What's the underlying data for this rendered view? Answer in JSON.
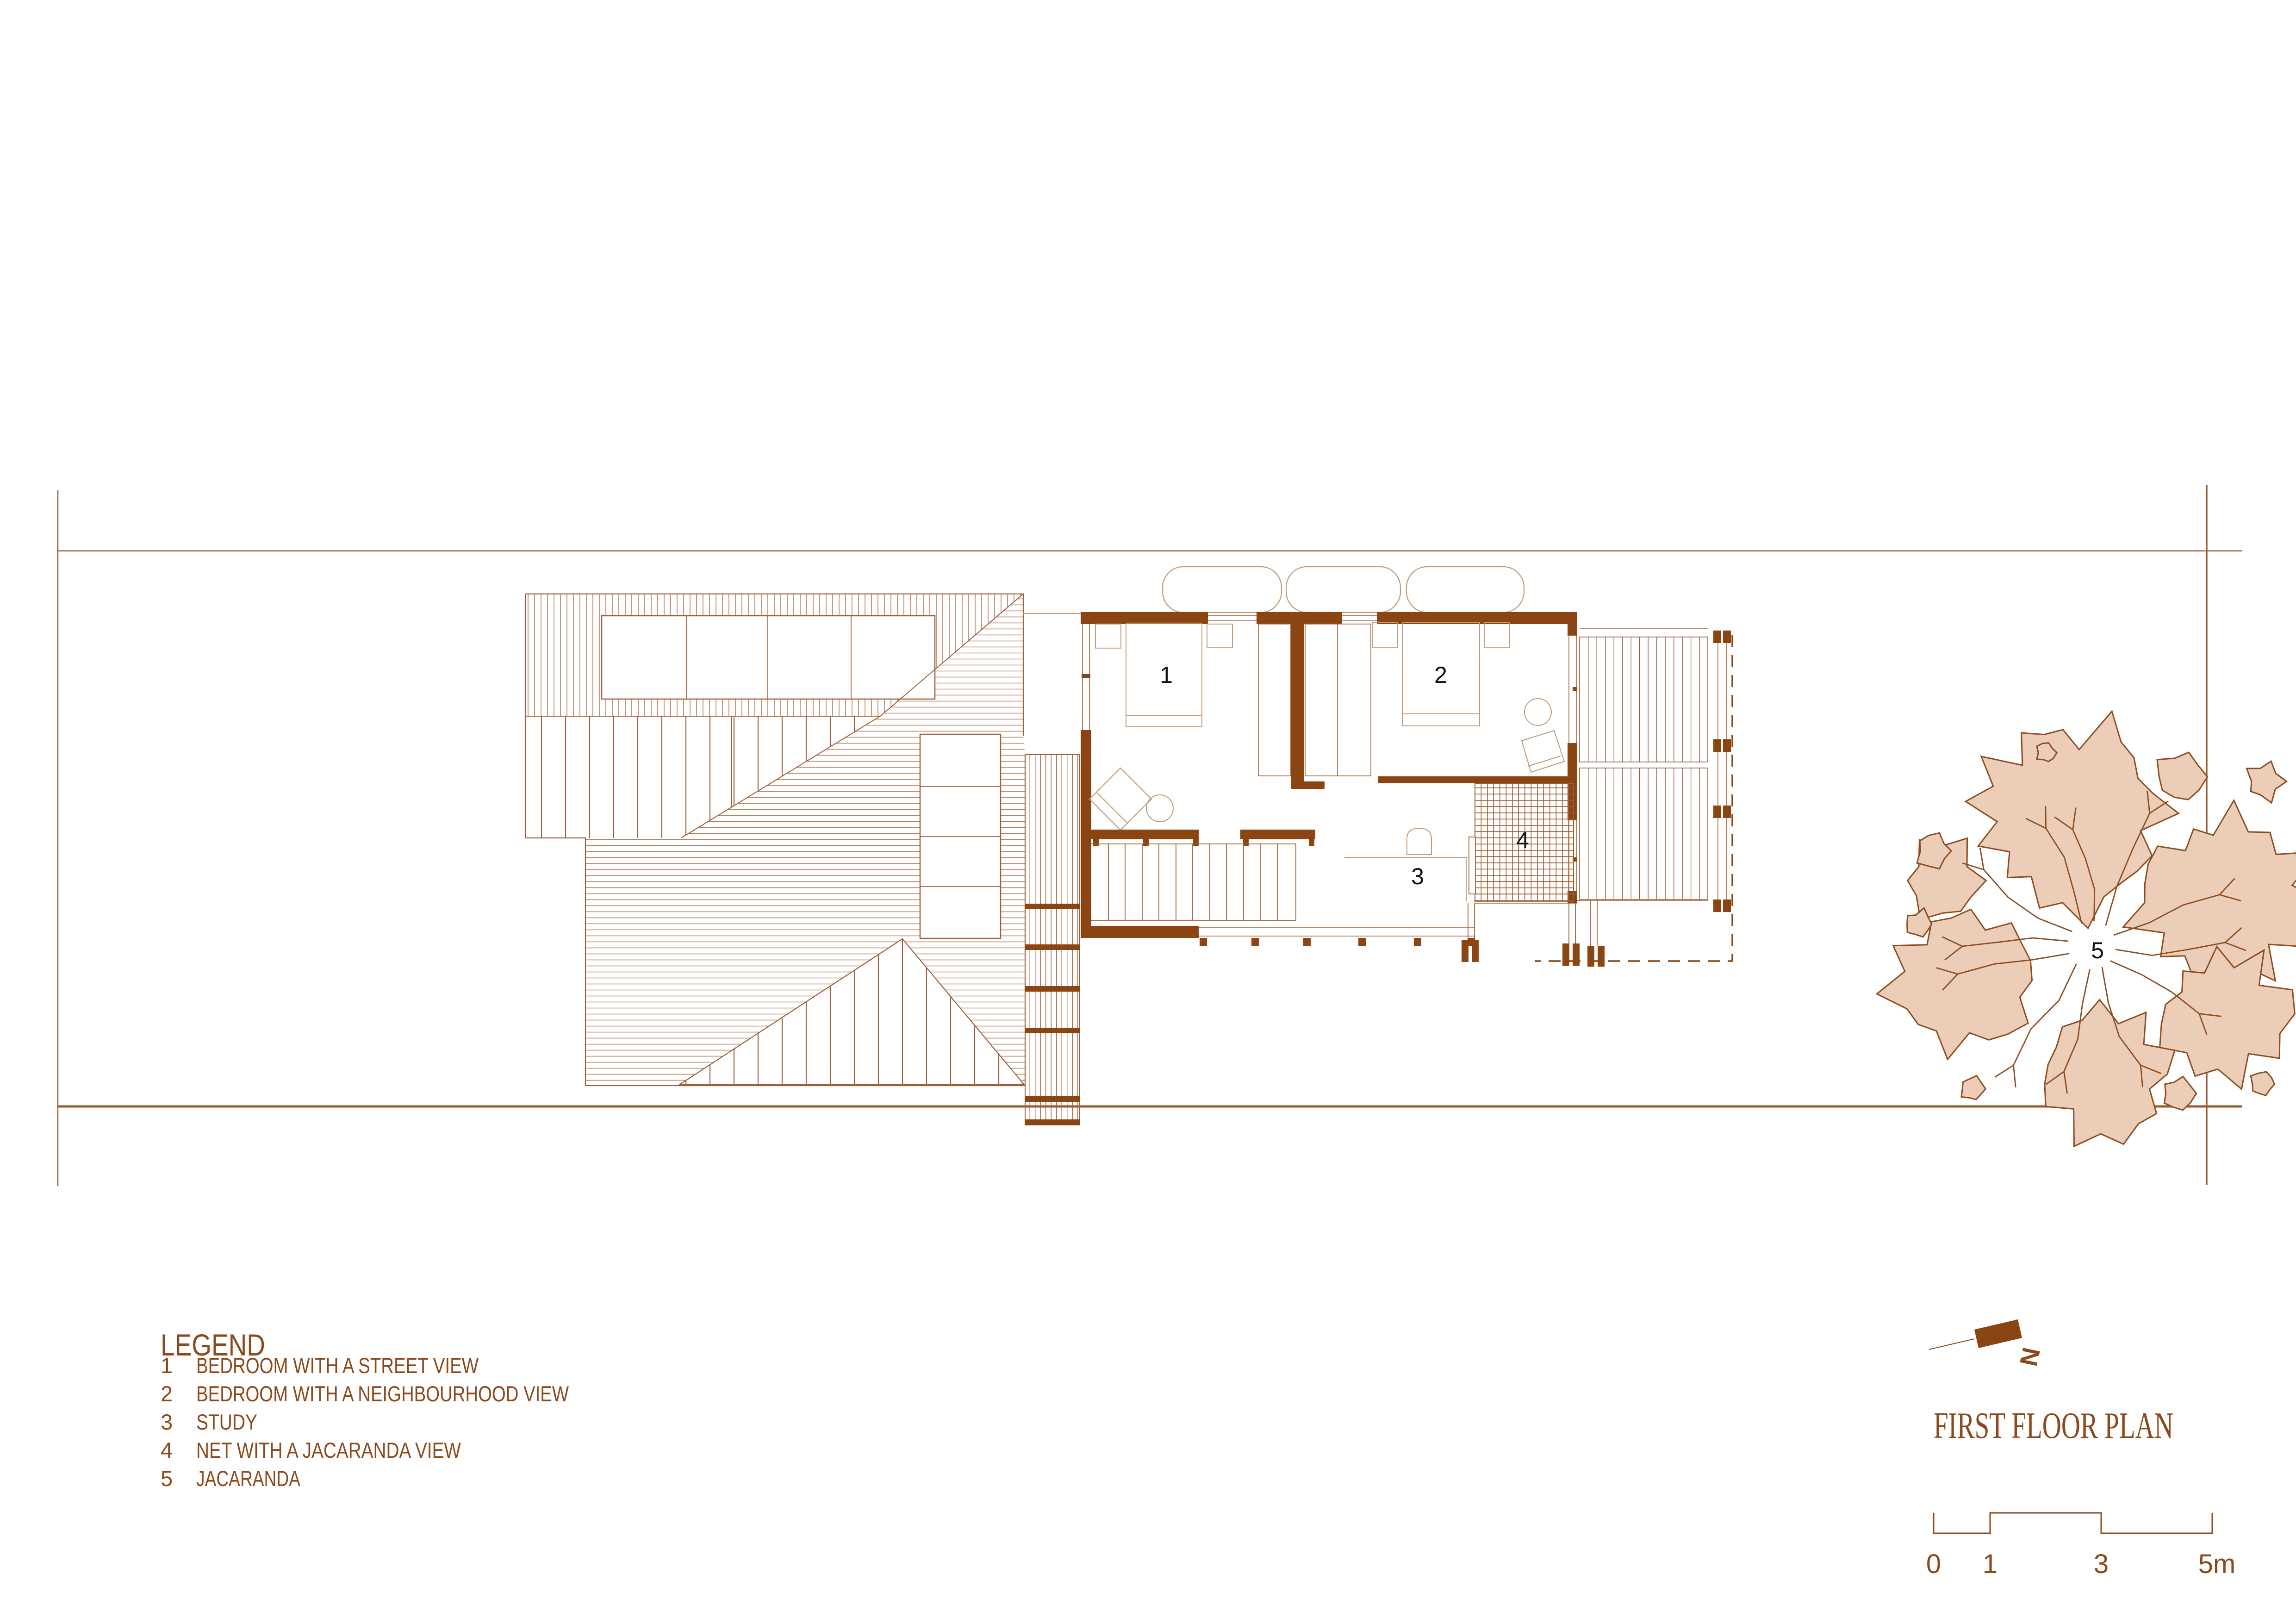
{
  "drawing": {
    "type": "architectural floor plan",
    "title_block": {
      "title": "FIRST FLOOR PLAN",
      "north_label": "N"
    },
    "legend": {
      "heading": "LEGEND",
      "items": [
        {
          "num": "1",
          "label": "BEDROOM WITH A STREET VIEW"
        },
        {
          "num": "2",
          "label": "BEDROOM WITH A NEIGHBOURHOOD VIEW"
        },
        {
          "num": "3",
          "label": "STUDY"
        },
        {
          "num": "4",
          "label": "NET WITH A JACARANDA VIEW"
        },
        {
          "num": "5",
          "label": "JACARANDA"
        }
      ]
    },
    "scale_bar": {
      "tick_labels": [
        "0",
        "1",
        "3",
        "5m"
      ]
    },
    "plan_room_numbers": {
      "bedroom_street": "1",
      "bedroom_neighbourhood": "2",
      "study": "3",
      "net": "4",
      "jacaranda_tree": "5"
    },
    "colors": {
      "ink_brown": "#8C4A1C",
      "wall_brown": "#8B4513",
      "hatch_light": "#B57D58",
      "line_medium": "#A0603A",
      "lot_line": "#9B5C30",
      "tree_fill": "#EBCDB8",
      "tree_outline": "#8D4D20",
      "room_label_black": "#111111"
    }
  }
}
